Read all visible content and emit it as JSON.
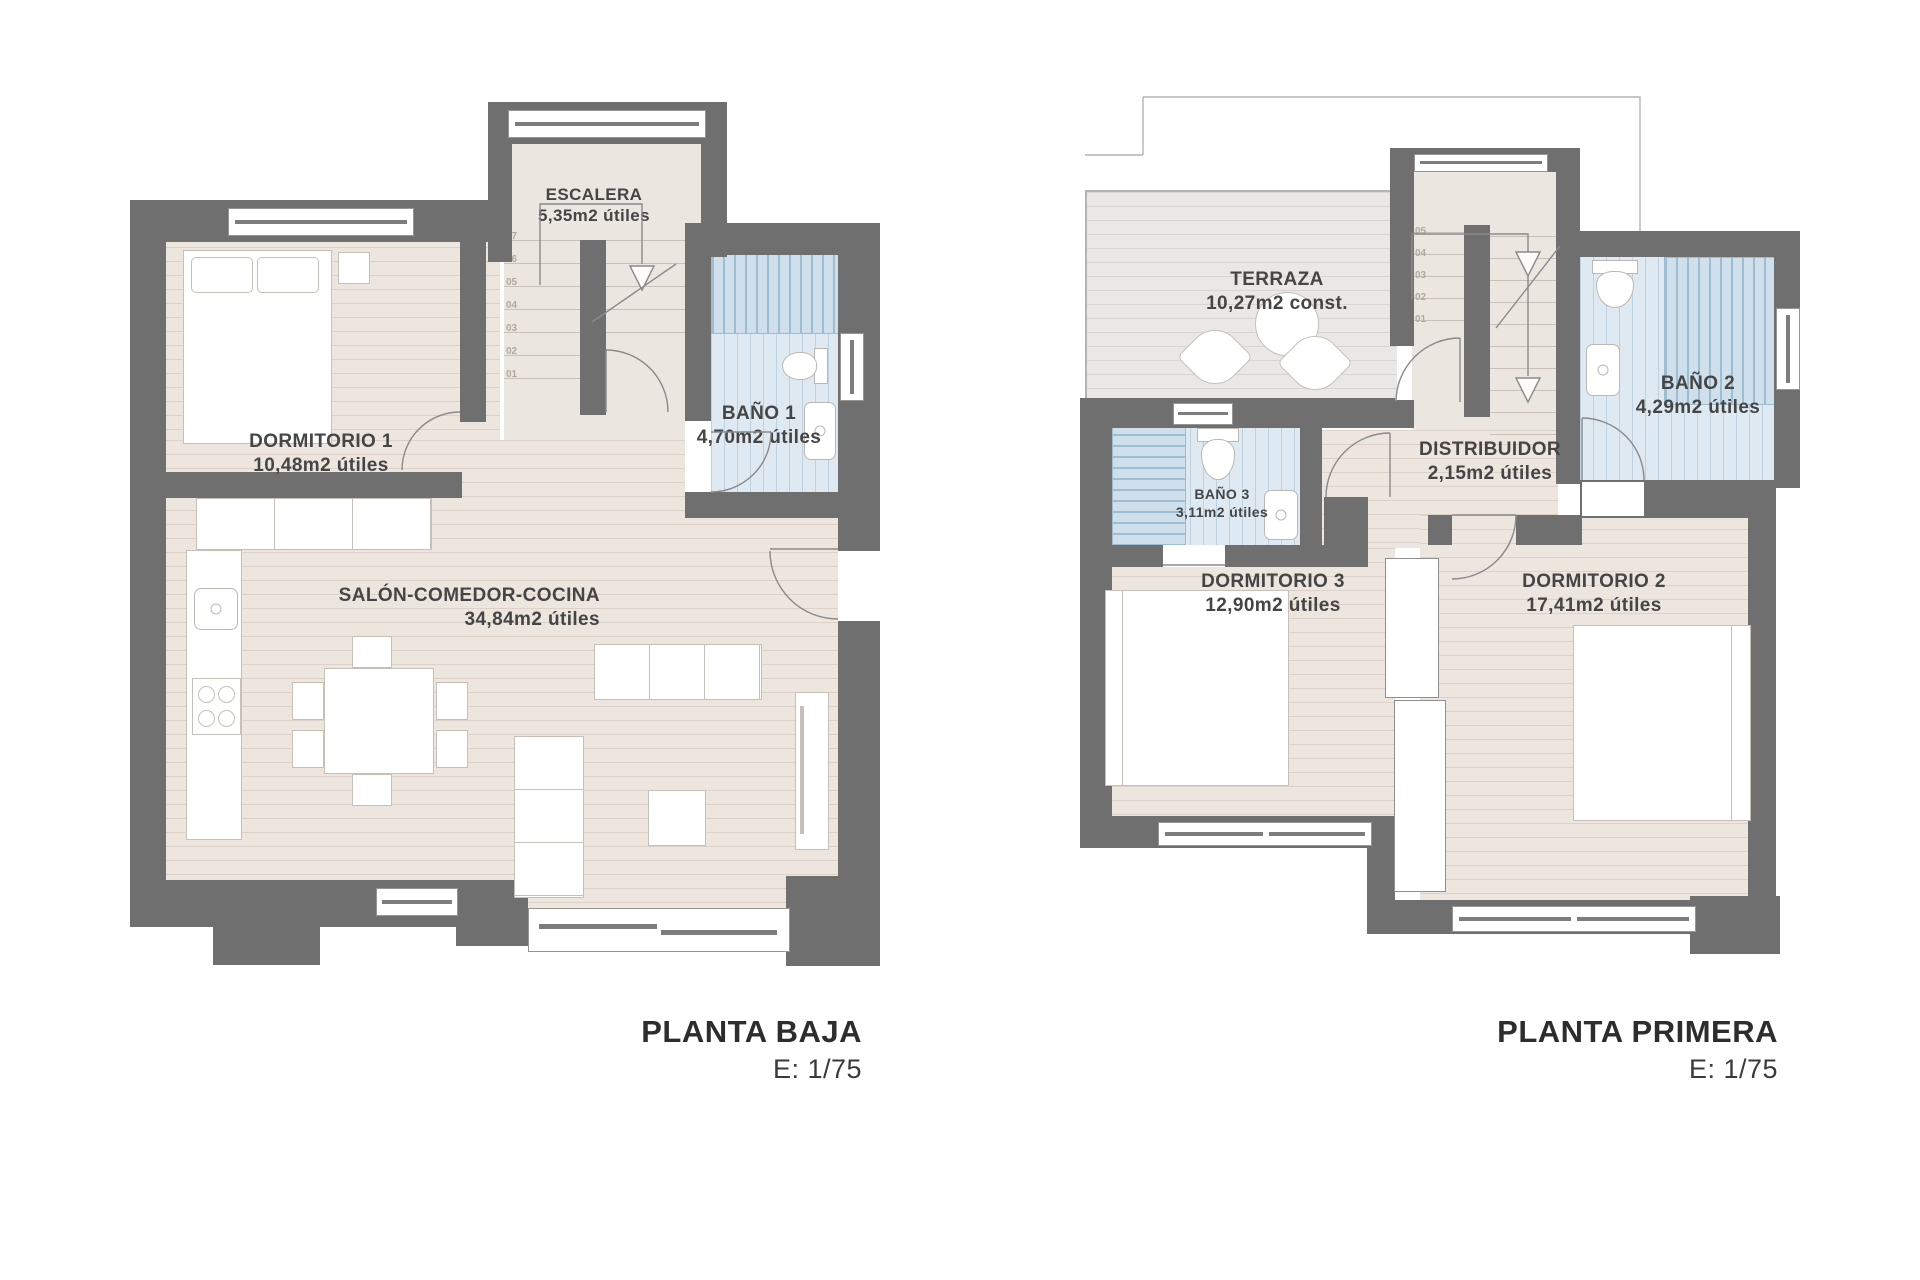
{
  "document": {
    "background": "#ffffff"
  },
  "plans": [
    {
      "title": "PLANTA BAJA",
      "scale_label": "E: 1/75",
      "rooms": {
        "escalera": {
          "name": "ESCALERA",
          "area": "5,35m2 útiles"
        },
        "dormitorio1": {
          "name": "DORMITORIO 1",
          "area": "10,48m2 útiles"
        },
        "bano1": {
          "name": "BAÑO 1",
          "area": "4,70m2 útiles"
        },
        "salon": {
          "name": "SALÓN-COMEDOR-COCINA",
          "area": "34,84m2 útiles"
        }
      },
      "stair_steps": [
        "07",
        "06",
        "05",
        "04",
        "03",
        "02",
        "01"
      ]
    },
    {
      "title": "PLANTA PRIMERA",
      "scale_label": "E: 1/75",
      "rooms": {
        "terraza": {
          "name": "TERRAZA",
          "area": "10,27m2 const."
        },
        "bano2": {
          "name": "BAÑO 2",
          "area": "4,29m2 útiles"
        },
        "bano3": {
          "name": "BAÑO 3",
          "area": "3,11m2 útiles"
        },
        "distribuidor": {
          "name": "DISTRIBUIDOR",
          "area": "2,15m2 útiles"
        },
        "dormitorio3": {
          "name": "DORMITORIO 3",
          "area": "12,90m2 útiles"
        },
        "dormitorio2": {
          "name": "DORMITORIO 2",
          "area": "17,41m2 útiles"
        }
      },
      "stair_steps": [
        "05",
        "04",
        "03",
        "02",
        "01"
      ]
    }
  ],
  "colors": {
    "wall": "#6f6f6f",
    "floor": "#ece6df",
    "floor_stripe": "#dcd2c7",
    "bath": "#dfe9f1",
    "bath_stripe": "#bdd2e0",
    "terrace": "#e9e8e6",
    "terrace_stripe": "#d8d6d2",
    "label_text": "#454545",
    "title_text": "#2d2d2d"
  }
}
